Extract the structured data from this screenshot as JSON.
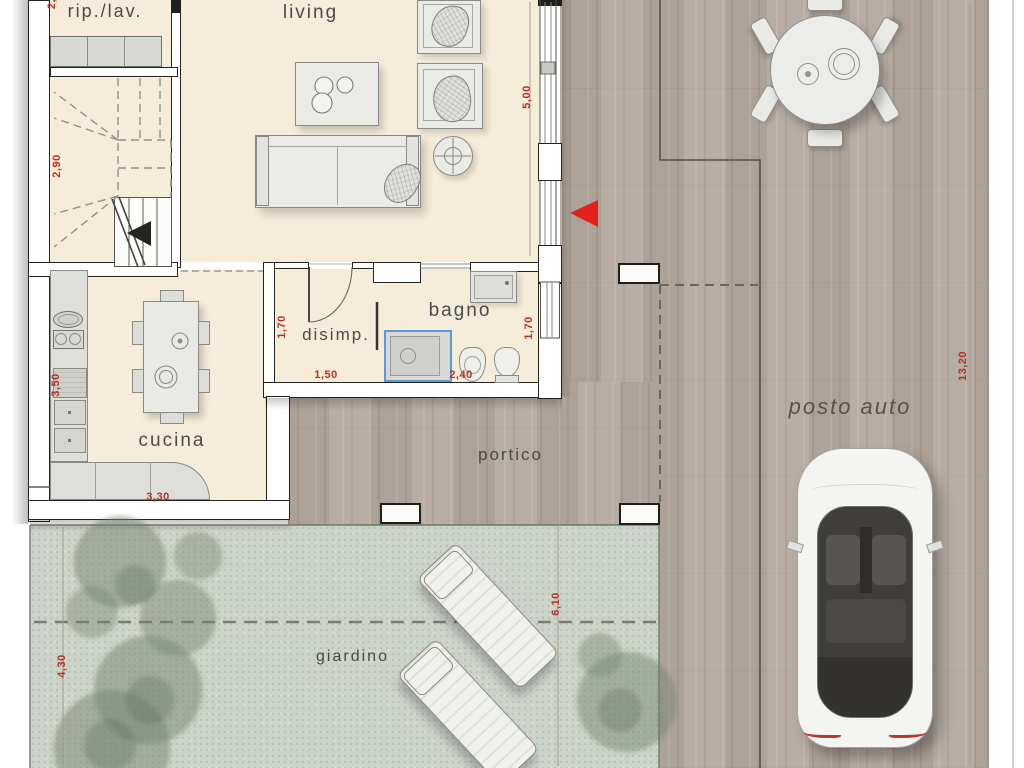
{
  "plan": {
    "labels": {
      "rip_lav": "rip./lav.",
      "living": "living",
      "disimp": "disimp.",
      "bagno": "bagno",
      "cucina": "cucina",
      "portico": "portico",
      "giardino": "giardino",
      "posto_auto": "posto auto"
    },
    "dims": {
      "riplav_cut": "2,",
      "stairs": "2,90",
      "living": "5,00",
      "disimp_h": "1,70",
      "disimp_w": "1,50",
      "bagno_w": "2,40",
      "bagno_h": "1,70",
      "cucina_h": "3,50",
      "cucina_w": "3,30",
      "giardino_h": "4,30",
      "giardino_w": "6,10",
      "lot": "13,20"
    },
    "colors": {
      "interior_floor": "#f6ecda",
      "deck_wood": "#b3a9a0",
      "garden": "#ccd3c8",
      "wall_outline": "#23231f",
      "dimension_red": "#b23327",
      "entrance_arrow_red": "#e32219",
      "shower_blue": "#5b9bd5"
    }
  }
}
